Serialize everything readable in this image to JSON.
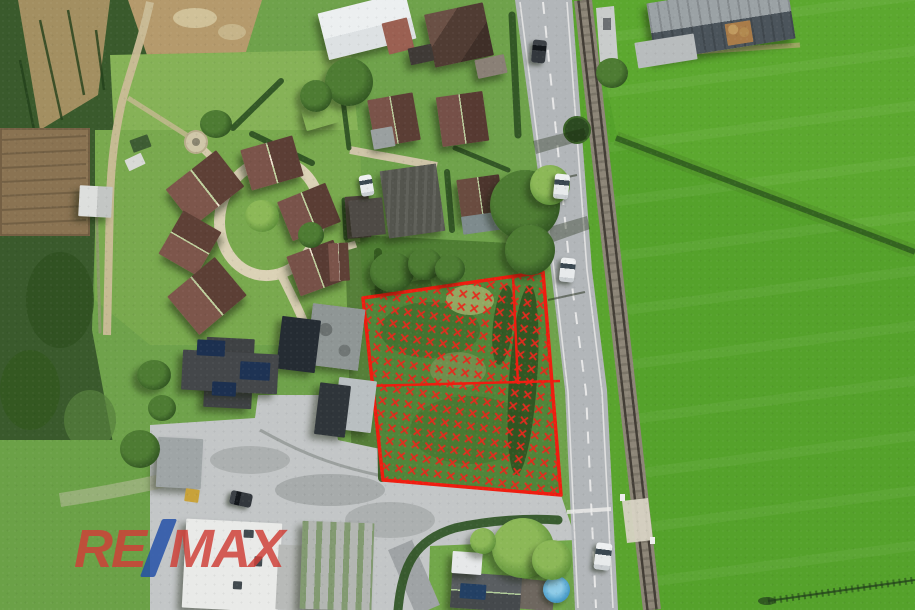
{
  "watermark": {
    "re": "RE",
    "slash": "/",
    "max": "MAX",
    "red": "#cf4038",
    "blue": "#2350a8"
  },
  "parcel": {
    "boundary_color": "#ef1d10",
    "marking_style": "red crosshatch over grass plot"
  },
  "scene": {
    "kind": "aerial drone photograph",
    "subject": "building plot outlined in red beside road and single-track railway"
  }
}
